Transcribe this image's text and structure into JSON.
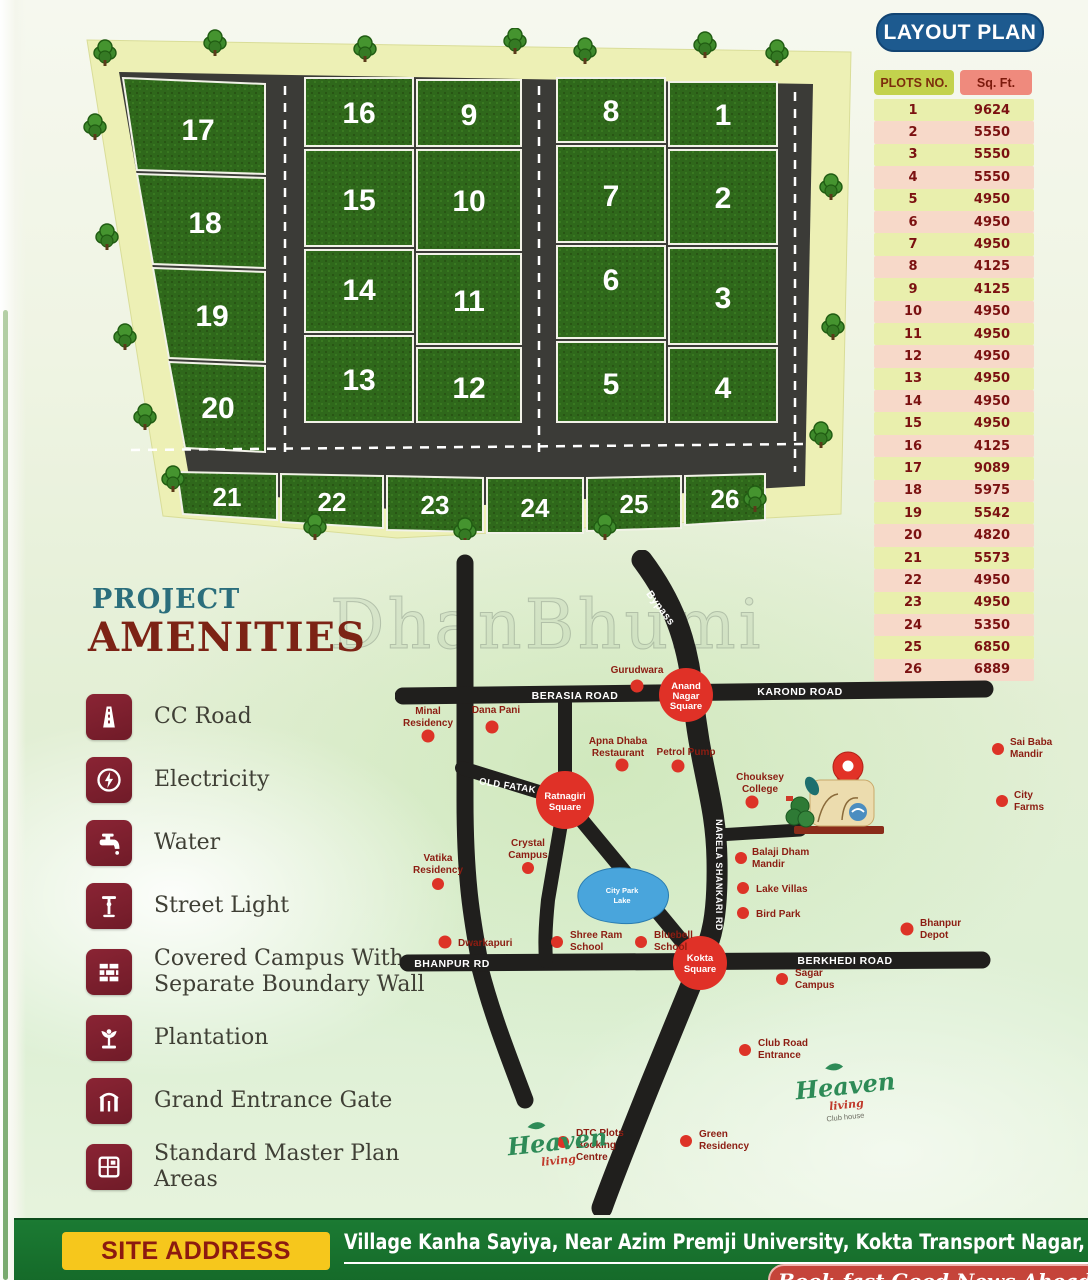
{
  "header": {
    "layout_plan_label": "LAYOUT PLAN"
  },
  "plots_table": {
    "col_plots": "PLOTS NO.",
    "col_sqft": "Sq. Ft.",
    "rows": [
      {
        "no": "1",
        "sqft": "9624"
      },
      {
        "no": "2",
        "sqft": "5550"
      },
      {
        "no": "3",
        "sqft": "5550"
      },
      {
        "no": "4",
        "sqft": "5550"
      },
      {
        "no": "5",
        "sqft": "4950"
      },
      {
        "no": "6",
        "sqft": "4950"
      },
      {
        "no": "7",
        "sqft": "4950"
      },
      {
        "no": "8",
        "sqft": "4125"
      },
      {
        "no": "9",
        "sqft": "4125"
      },
      {
        "no": "10",
        "sqft": "4950"
      },
      {
        "no": "11",
        "sqft": "4950"
      },
      {
        "no": "12",
        "sqft": "4950"
      },
      {
        "no": "13",
        "sqft": "4950"
      },
      {
        "no": "14",
        "sqft": "4950"
      },
      {
        "no": "15",
        "sqft": "4950"
      },
      {
        "no": "16",
        "sqft": "4125"
      },
      {
        "no": "17",
        "sqft": "9089"
      },
      {
        "no": "18",
        "sqft": "5975"
      },
      {
        "no": "19",
        "sqft": "5542"
      },
      {
        "no": "20",
        "sqft": "4820"
      },
      {
        "no": "21",
        "sqft": "5573"
      },
      {
        "no": "22",
        "sqft": "4950"
      },
      {
        "no": "23",
        "sqft": "4950"
      },
      {
        "no": "24",
        "sqft": "5350"
      },
      {
        "no": "25",
        "sqft": "6850"
      },
      {
        "no": "26",
        "sqft": "6889"
      }
    ]
  },
  "layout": {
    "plots": [
      "17",
      "18",
      "19",
      "20",
      "16",
      "15",
      "14",
      "13",
      "9",
      "10",
      "11",
      "12",
      "8",
      "7",
      "6",
      "5",
      "1",
      "2",
      "3",
      "4",
      "21",
      "22",
      "23",
      "24",
      "25",
      "26"
    ]
  },
  "watermark": "DhanBhumi",
  "amenities": {
    "title_line1": "PROJECT",
    "title_line2": "AMENITIES",
    "items": [
      {
        "icon": "road-icon",
        "label": "CC Road"
      },
      {
        "icon": "electricity-icon",
        "label": "Electricity"
      },
      {
        "icon": "water-tap-icon",
        "label": "Water"
      },
      {
        "icon": "street-light-icon",
        "label": "Street Light"
      },
      {
        "icon": "boundary-wall-icon",
        "label": "Covered Campus With Separate Boundary Wall"
      },
      {
        "icon": "plantation-icon",
        "label": "Plantation"
      },
      {
        "icon": "entrance-gate-icon",
        "label": "Grand Entrance Gate"
      },
      {
        "icon": "master-plan-icon",
        "label": "Standard Master Plan Areas"
      }
    ]
  },
  "map": {
    "road_labels": {
      "top_left": "BERASIA ROAD",
      "top_right": "KAROND ROAD",
      "bypass": "Bypass",
      "vertical": "NARELA SHANKARI RD",
      "bottom_left": "BHANPUR RD",
      "bottom_right": "BERKHEDI ROAD",
      "old_road": "OLD FATAK RD"
    },
    "junctions": [
      {
        "l1": "Anand",
        "l2": "Nagar",
        "l3": "Square"
      },
      {
        "l1": "Ratnagiri",
        "l2": "Square"
      },
      {
        "l1": "Kokta",
        "l2": "Square"
      }
    ],
    "lake": {
      "l1": "City Park",
      "l2": "Lake"
    },
    "pois": [
      {
        "l1": "Minal",
        "l2": "Residency"
      },
      {
        "l1": "Dana Pani"
      },
      {
        "l1": "Gurudwara"
      },
      {
        "l1": "Chouksey",
        "l2": "College"
      },
      {
        "l1": "Apna Dhaba",
        "l2": "Restaurant"
      },
      {
        "l1": "Petrol Pump"
      },
      {
        "l1": "Crystal",
        "l2": "Campus"
      },
      {
        "l1": "Vatika",
        "l2": "Residency"
      },
      {
        "l1": "Balaji Dham",
        "l2": "Mandir"
      },
      {
        "l1": "Lake Villas"
      },
      {
        "l1": "Bird Park"
      },
      {
        "l1": "Bhanpur",
        "l2": "Depot"
      },
      {
        "l1": "Dwarkapuri"
      },
      {
        "l1": "Shree Ram",
        "l2": "School"
      },
      {
        "l1": "Bluebell",
        "l2": "School"
      },
      {
        "l1": "Sagar",
        "l2": "Campus"
      },
      {
        "l1": "Club Road",
        "l2": "Entrance"
      },
      {
        "l1": "DTC Plots",
        "l2": "Booking",
        "l3": "Centre"
      },
      {
        "l1": "Green",
        "l2": "Residency"
      },
      {
        "l1": "Sai Baba",
        "l2": "Mandir"
      },
      {
        "l1": "City",
        "l2": "Farms"
      }
    ],
    "logos": [
      {
        "name": "Heaven",
        "sub": "living",
        "tag": ""
      },
      {
        "name": "Heaven",
        "sub": "living",
        "tag": "Club house"
      }
    ]
  },
  "footer": {
    "badge": "SITE ADDRESS",
    "address": "Village Kanha Sayiya, Near Azim Premji University, Kokta Transport Nagar, Bhopal",
    "ribbon_text": "Book fast Good News Ahead"
  }
}
